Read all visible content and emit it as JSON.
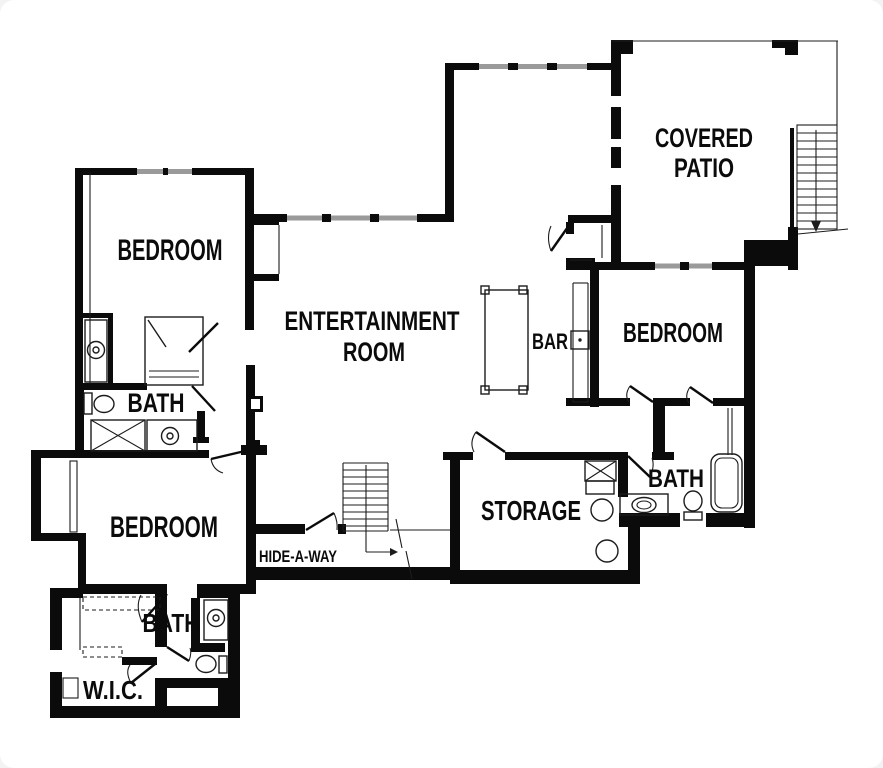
{
  "colors": {
    "wall": "#0b0b0b",
    "thin": "#1c1c1c",
    "window": "#9a9a9a",
    "background": "#ffffff"
  },
  "labels": {
    "bedroom_upper_left": "BEDROOM",
    "entertainment_line1": "ENTERTAINMENT",
    "entertainment_line2": "ROOM",
    "bar": "BAR",
    "covered_patio_line1": "COVERED",
    "covered_patio_line2": "PATIO",
    "bedroom_right": "BEDROOM",
    "bath_upper": "BATH",
    "bedroom_lower_left": "BEDROOM",
    "hide_a_way": "HIDE-A-WAY",
    "storage": "STORAGE",
    "bath_right": "BATH",
    "bath_lower": "BATH",
    "wic": "W.I.C."
  }
}
